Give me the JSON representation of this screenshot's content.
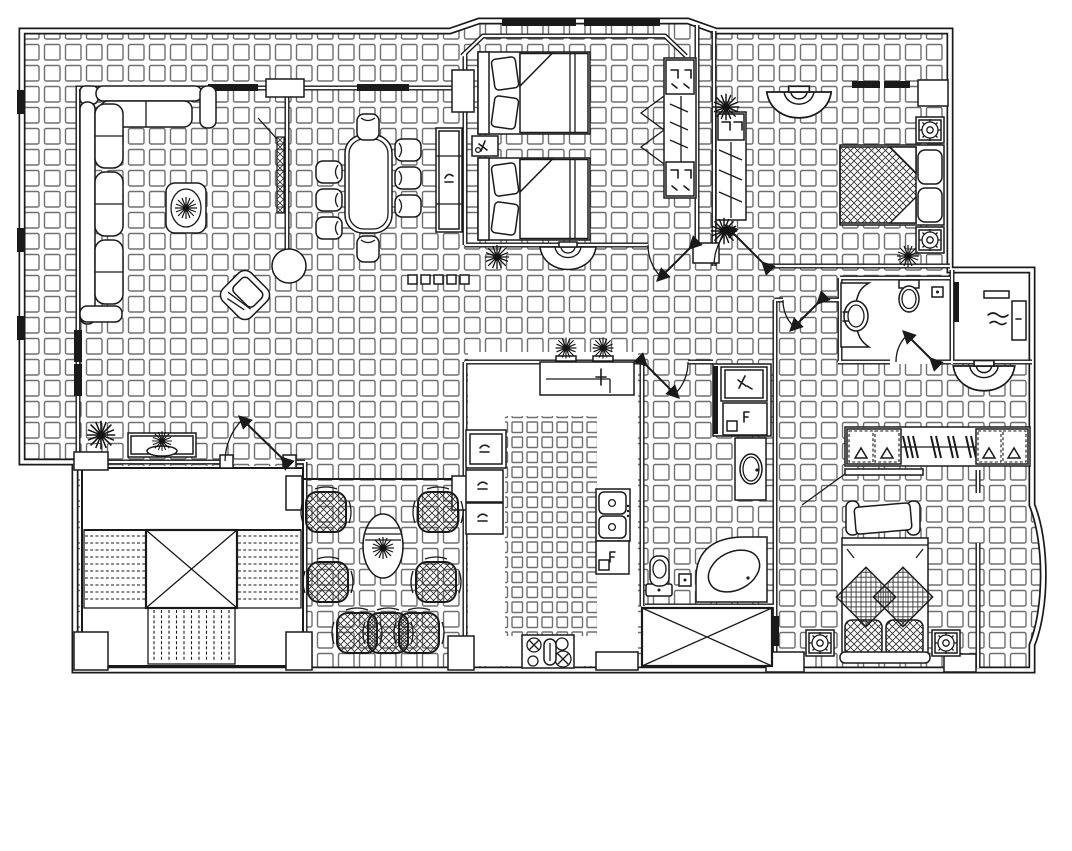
{
  "document": {
    "title": "Residential apartment floor plan - CAD line drawing",
    "type": "architectural-floor-plan",
    "sheet": {
      "width_px": 1072,
      "height_px": 851,
      "background": "#ffffff"
    }
  },
  "palette": {
    "line": "#1a1a1a",
    "tile_line": "#6f6f6f",
    "hatch_line": "#2a2a2a",
    "paper": "#ffffff",
    "window_fill": "#000000"
  },
  "floor_finishes": [
    {
      "area": "general living areas, bedrooms, halls",
      "pattern": "square ceramic tile grid"
    },
    {
      "area": "kitchen floor",
      "pattern": "smaller dense tile grid"
    },
    {
      "area": "stair hall, guest bathroom, dressing room",
      "pattern": "plain (untiled)"
    }
  ],
  "rooms": [
    {
      "id": "terrace-gallery"
    },
    {
      "id": "living-room"
    },
    {
      "id": "dining-area"
    },
    {
      "id": "twin-bedroom"
    },
    {
      "id": "double-bedroom"
    },
    {
      "id": "hallway"
    },
    {
      "id": "guest-bathroom"
    },
    {
      "id": "dressing-room"
    },
    {
      "id": "dressing-corridor"
    },
    {
      "id": "walk-in-closet"
    },
    {
      "id": "master-bedroom"
    },
    {
      "id": "family-bathroom"
    },
    {
      "id": "laundry-nook"
    },
    {
      "id": "kitchen"
    },
    {
      "id": "seating-lounge"
    },
    {
      "id": "stair-hall"
    },
    {
      "id": "service-shaft"
    }
  ],
  "furniture": [
    {
      "id": "corner-sofa",
      "room": "living-room"
    },
    {
      "id": "coffee-table-with-plant",
      "room": "living-room"
    },
    {
      "id": "accent-armchair",
      "room": "living-room"
    },
    {
      "id": "tv-panel",
      "room": "living-room"
    },
    {
      "id": "round-column",
      "room": "living-room"
    },
    {
      "id": "dining-table",
      "room": "dining-area"
    },
    {
      "id": "dining-chairs",
      "count": 8,
      "room": "dining-area"
    },
    {
      "id": "sideboard",
      "room": "dining-area"
    },
    {
      "id": "twin-bed",
      "count": 2,
      "room": "twin-bedroom"
    },
    {
      "id": "nightstand",
      "room": "twin-bedroom"
    },
    {
      "id": "open-wardrobe",
      "room": "twin-bedroom"
    },
    {
      "id": "double-bed-crosshatch",
      "room": "double-bedroom"
    },
    {
      "id": "bedside-lamp-table",
      "count": 2,
      "room": "double-bedroom"
    },
    {
      "id": "tall-wardrobe",
      "room": "double-bedroom"
    },
    {
      "id": "wall-light-dome",
      "count": 3
    },
    {
      "id": "vanity-basin",
      "room": "guest-bathroom"
    },
    {
      "id": "toilet",
      "count": 2
    },
    {
      "id": "corner-bathtub",
      "room": "family-bathroom"
    },
    {
      "id": "wash-basin-counter",
      "room": "family-bathroom"
    },
    {
      "id": "washing-machine-units",
      "room": "laundry-nook"
    },
    {
      "id": "kitchen-pass-counter",
      "room": "kitchen"
    },
    {
      "id": "kitchen-cabinets",
      "count": 3,
      "room": "kitchen"
    },
    {
      "id": "double-sink",
      "room": "kitchen"
    },
    {
      "id": "sink-cabinet",
      "room": "kitchen"
    },
    {
      "id": "cooktop-4-burner",
      "room": "kitchen"
    },
    {
      "id": "lounge-armchair",
      "count": 7,
      "room": "seating-lounge"
    },
    {
      "id": "oval-tea-table-with-plant",
      "room": "seating-lounge"
    },
    {
      "id": "console-table",
      "room": "living-room"
    },
    {
      "id": "staircase-u-shape",
      "room": "stair-hall"
    },
    {
      "id": "stair-core-void-x",
      "room": "stair-hall"
    },
    {
      "id": "long-wardrobe-with-hangers",
      "room": "walk-in-closet"
    },
    {
      "id": "bench",
      "room": "master-bedroom"
    },
    {
      "id": "master-bed-diamond-pillows",
      "room": "master-bedroom"
    },
    {
      "id": "dressing-shelf",
      "room": "dressing-room"
    },
    {
      "id": "potted-plant",
      "count": 10
    }
  ],
  "doors": [
    {
      "id": "entry-double-door"
    },
    {
      "id": "twin-bedroom-door"
    },
    {
      "id": "double-bedroom-door"
    },
    {
      "id": "corridor-door"
    },
    {
      "id": "guest-bathroom-door"
    },
    {
      "id": "family-bathroom-door"
    }
  ],
  "annotations": {
    "tiny_labels": {
      "legible": false,
      "approx_count": 12,
      "description": "tiny scribbled fixture labels, unreadable at this resolution"
    }
  }
}
